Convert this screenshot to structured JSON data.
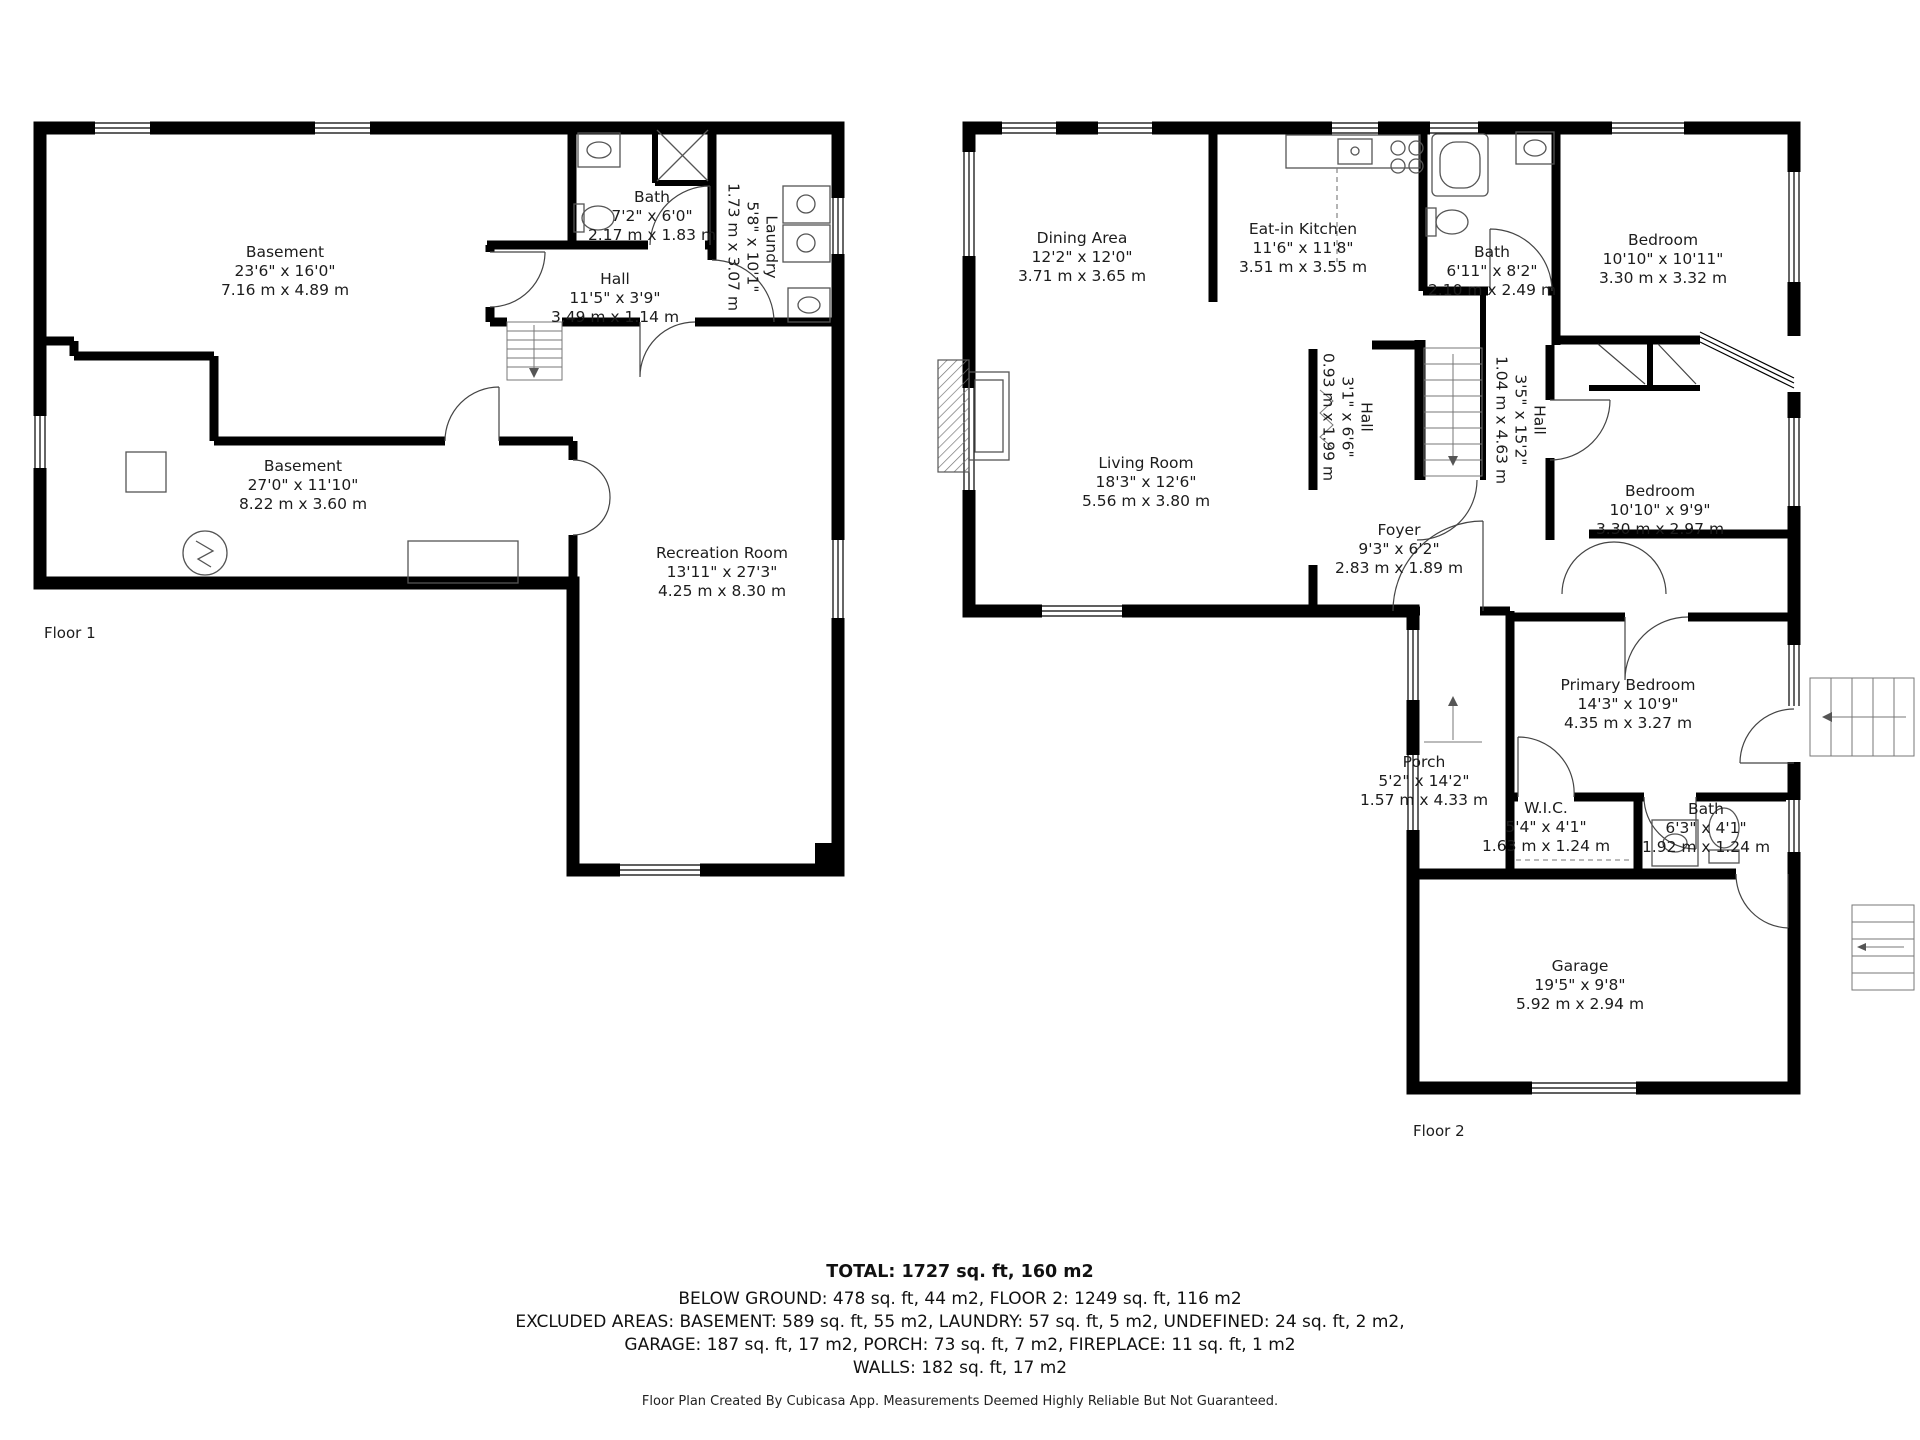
{
  "floor1": {
    "label": "Floor 1",
    "rooms": [
      {
        "name": "Basement",
        "ft": "23'6\" x 16'0\"",
        "m": "7.16 m x 4.89 m"
      },
      {
        "name": "Bath",
        "ft": "7'2\" x 6'0\"",
        "m": "2.17 m x 1.83 m"
      },
      {
        "name": "Laundry",
        "ft": "5'8\" x 10'1\"",
        "m": "1.73 m x 3.07 m"
      },
      {
        "name": "Hall",
        "ft": "11'5\" x 3'9\"",
        "m": "3.49 m x 1.14 m"
      },
      {
        "name": "Basement",
        "ft": "27'0\" x 11'10\"",
        "m": "8.22 m x 3.60 m"
      },
      {
        "name": "Recreation Room",
        "ft": "13'11\" x 27'3\"",
        "m": "4.25 m x 8.30 m"
      }
    ]
  },
  "floor2": {
    "label": "Floor 2",
    "rooms": [
      {
        "name": "Dining Area",
        "ft": "12'2\" x 12'0\"",
        "m": "3.71 m x 3.65 m"
      },
      {
        "name": "Eat-in Kitchen",
        "ft": "11'6\" x 11'8\"",
        "m": "3.51 m x 3.55 m"
      },
      {
        "name": "Bath",
        "ft": "6'11\" x 8'2\"",
        "m": "2.10 m x 2.49 m"
      },
      {
        "name": "Bedroom",
        "ft": "10'10\" x 10'11\"",
        "m": "3.30 m x 3.32 m"
      },
      {
        "name": "Living Room",
        "ft": "18'3\" x 12'6\"",
        "m": "5.56 m x 3.80 m"
      },
      {
        "name": "Hall",
        "ft": "3'1\" x 6'6\"",
        "m": "0.93 m x 1.99 m"
      },
      {
        "name": "Hall",
        "ft": "3'5\" x 15'2\"",
        "m": "1.04 m x 4.63 m"
      },
      {
        "name": "Foyer",
        "ft": "9'3\" x 6'2\"",
        "m": "2.83 m x 1.89 m"
      },
      {
        "name": "Bedroom",
        "ft": "10'10\" x 9'9\"",
        "m": "3.30 m x 2.97 m"
      },
      {
        "name": "Primary Bedroom",
        "ft": "14'3\" x 10'9\"",
        "m": "4.35 m x 3.27 m"
      },
      {
        "name": "Porch",
        "ft": "5'2\" x 14'2\"",
        "m": "1.57 m x 4.33 m"
      },
      {
        "name": "W.I.C.",
        "ft": "5'4\" x 4'1\"",
        "m": "1.63 m x 1.24 m"
      },
      {
        "name": "Bath",
        "ft": "6'3\" x 4'1\"",
        "m": "1.92 m x 1.24 m"
      },
      {
        "name": "Garage",
        "ft": "19'5\" x 9'8\"",
        "m": "5.92 m x 2.94 m"
      }
    ]
  },
  "summary": {
    "total": "TOTAL: 1727 sq. ft, 160 m2",
    "below_ground": "BELOW GROUND: 478 sq. ft, 44 m2, FLOOR 2: 1249 sq. ft, 116 m2",
    "excluded": "EXCLUDED AREAS: BASEMENT: 589 sq. ft, 55 m2, LAUNDRY: 57 sq. ft, 5 m2, UNDEFINED: 24 sq. ft, 2 m2,",
    "garage_line": "GARAGE: 187 sq. ft, 17 m2, PORCH: 73 sq. ft, 7 m2, FIREPLACE: 11 sq. ft, 1 m2",
    "walls_line": "WALLS: 182 sq. ft, 17 m2"
  },
  "footer": "Floor Plan Created By Cubicasa App. Measurements Deemed Highly Reliable But Not Guaranteed."
}
